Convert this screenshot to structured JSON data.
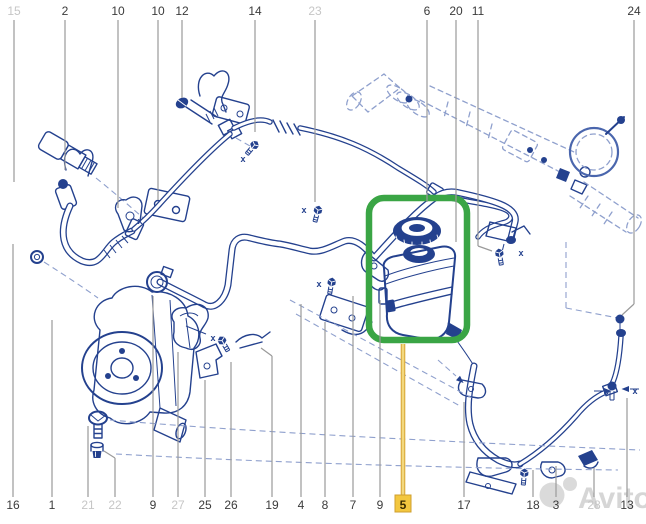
{
  "colors": {
    "ink": "#24418e",
    "ghost": "#8fa0cd",
    "mid": "#4a66ad",
    "callout_line": "#9a9a9a",
    "label": "#3b3b3b",
    "label_dim": "#c6c6c6",
    "watermark_gray": "#bcbcbc",
    "background": "#ffffff"
  },
  "highlight": {
    "highlighted_part": "5",
    "box_color": "#3aa545",
    "line_color": "#d9a93a",
    "line_core": "#f3d87e",
    "label_bg": "#f3c73f",
    "label_border": "#cf9f2f",
    "label_text": "#3a2c00"
  },
  "watermark": {
    "text": "Avito"
  },
  "callouts": {
    "top": [
      {
        "label": "15",
        "x": 14,
        "y2": 182,
        "dim": true
      },
      {
        "label": "2",
        "x": 65,
        "y2": 170,
        "dim": false
      },
      {
        "label": "10",
        "x": 118,
        "y2": 208,
        "dim": false
      },
      {
        "label": "10",
        "x": 158,
        "y2": 200,
        "dim": false
      },
      {
        "label": "12",
        "x": 182,
        "y2": 98,
        "dim": false
      },
      {
        "label": "14",
        "x": 255,
        "y2": 132,
        "dim": false
      },
      {
        "label": "23",
        "x": 315,
        "y2": 202,
        "dim": true
      },
      {
        "label": "6",
        "x": 427,
        "y2": 202,
        "dim": false
      },
      {
        "label": "20",
        "x": 456,
        "y2": 242,
        "dim": false
      },
      {
        "label": "11",
        "x": 478,
        "y2": 246,
        "dim": false
      },
      {
        "label": "24",
        "x": 634,
        "y2": 304,
        "dim": false
      }
    ],
    "bottom": [
      {
        "label": "16",
        "x": 13,
        "y1": 244,
        "dim": false
      },
      {
        "label": "1",
        "x": 52,
        "y1": 320,
        "dim": false
      },
      {
        "label": "21",
        "x": 88,
        "y1": 426,
        "dim": true
      },
      {
        "label": "22",
        "x": 115,
        "y1": 458,
        "dim": true
      },
      {
        "label": "9",
        "x": 153,
        "y1": 296,
        "dim": false
      },
      {
        "label": "27",
        "x": 178,
        "y1": 352,
        "dim": true
      },
      {
        "label": "25",
        "x": 205,
        "y1": 380,
        "dim": false
      },
      {
        "label": "26",
        "x": 231,
        "y1": 362,
        "dim": false
      },
      {
        "label": "19",
        "x": 272,
        "y1": 356,
        "dim": false
      },
      {
        "label": "4",
        "x": 301,
        "y1": 304,
        "dim": false
      },
      {
        "label": "8",
        "x": 325,
        "y1": 322,
        "dim": false
      },
      {
        "label": "7",
        "x": 353,
        "y1": 296,
        "dim": false
      },
      {
        "label": "9",
        "x": 380,
        "y1": 300,
        "dim": false
      },
      {
        "label": "5",
        "x": 403,
        "y1": 344,
        "dim": false,
        "highlight": true
      },
      {
        "label": "17",
        "x": 464,
        "y1": 402,
        "dim": false
      },
      {
        "label": "18",
        "x": 533,
        "y1": 470,
        "dim": false
      },
      {
        "label": "3",
        "x": 556,
        "y1": 466,
        "dim": false
      },
      {
        "label": "28",
        "x": 594,
        "y1": 468,
        "dim": true
      },
      {
        "label": "13",
        "x": 627,
        "y1": 398,
        "dim": false
      }
    ]
  }
}
